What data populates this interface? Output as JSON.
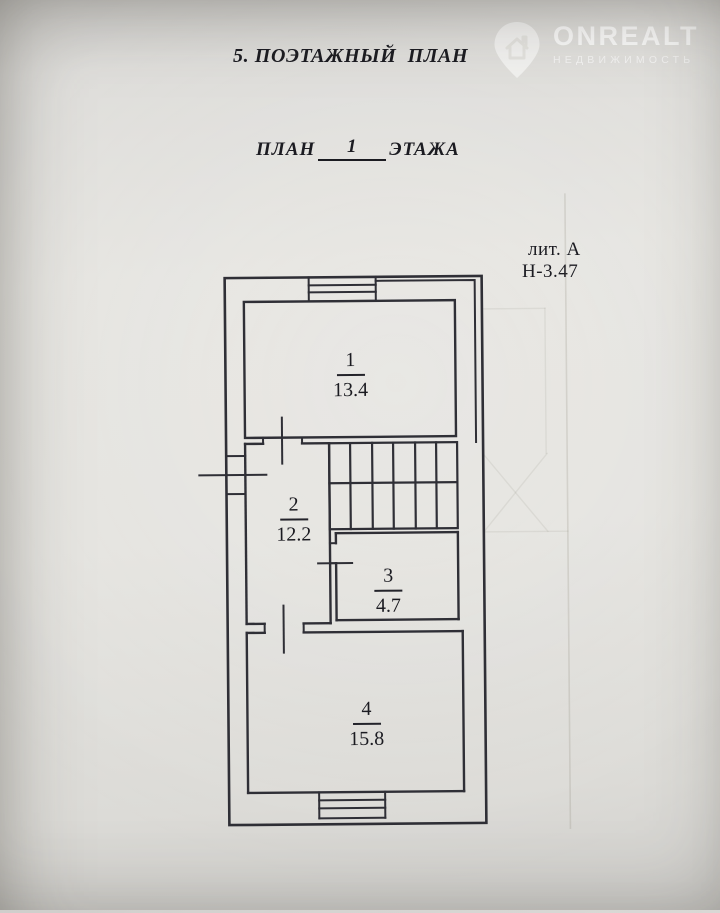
{
  "document": {
    "section_title": "5. ПОЭТАЖНЫЙ  ПЛАН",
    "plan_title": {
      "prefix": "ПЛАН",
      "floor": "1",
      "suffix": "ЭТАЖА"
    },
    "building_letter": "лит. А",
    "ceiling_height": "Н-3.47"
  },
  "watermark": {
    "brand": "ONREALT",
    "tagline": "НЕДВИЖИМОСТЬ",
    "icon": "map-pin-house-icon"
  },
  "rooms": [
    {
      "number": "1",
      "area": "13.4"
    },
    {
      "number": "2",
      "area": "12.2"
    },
    {
      "number": "3",
      "area": "4.7"
    },
    {
      "number": "4",
      "area": "15.8"
    }
  ],
  "colors": {
    "paper": "#e5e4e0",
    "ink": "#2f2f36",
    "watermark": "#ffffff"
  }
}
